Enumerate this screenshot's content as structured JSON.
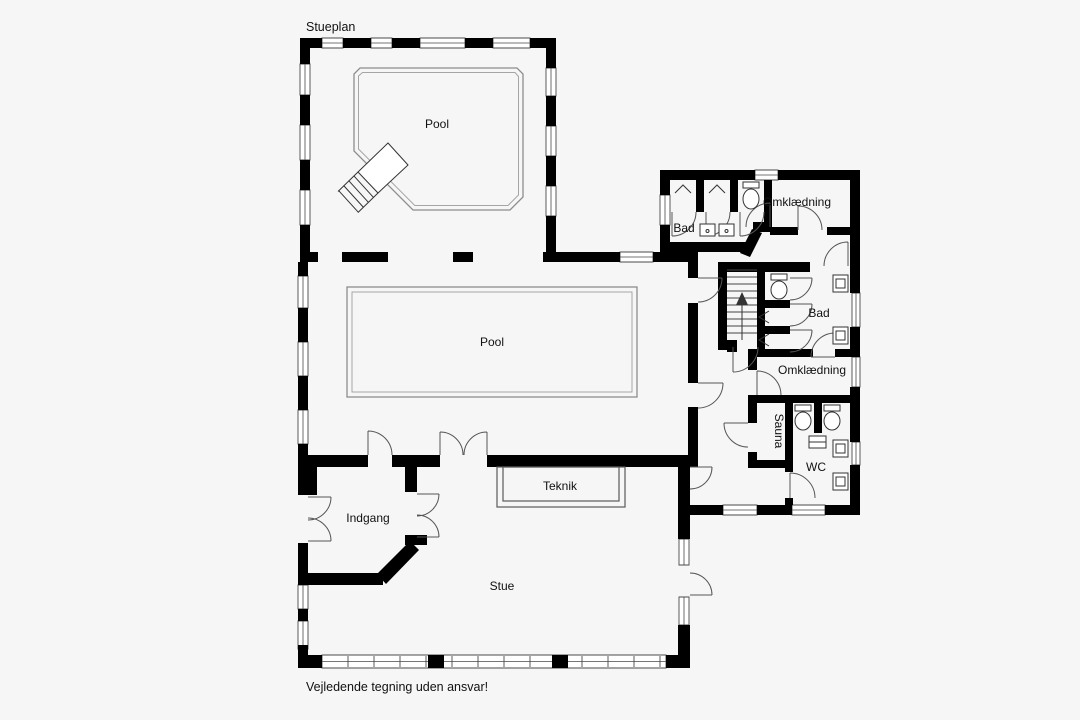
{
  "drawing": {
    "title": "Stueplan",
    "disclaimer": "Vejledende tegning uden ansvar!"
  },
  "rooms": {
    "pool_upper": "Pool",
    "pool_main": "Pool",
    "bad_upper": "Bad",
    "omklaedning_upper": "Omklædning",
    "bad_mid": "Bad",
    "omklaedning_mid": "Omklædning",
    "sauna": "Sauna",
    "wc": "WC",
    "teknik": "Teknik",
    "indgang": "Indgang",
    "stue": "Stue"
  },
  "colors": {
    "wall": "#000000",
    "window": "#4a4a4a",
    "pool_outline": "#8d8d8d",
    "background": "#f6f6f6",
    "text": "#111111"
  },
  "icons": {
    "stairs_direction": "up"
  }
}
